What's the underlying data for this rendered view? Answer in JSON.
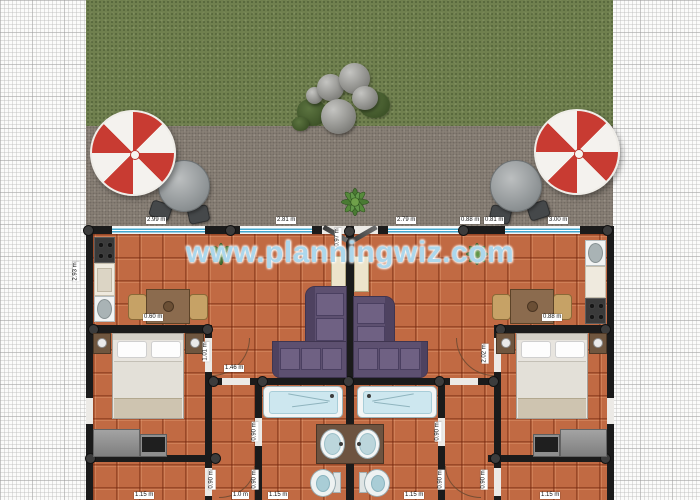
{
  "watermark": {
    "text": "www.planningwiz.com"
  },
  "dimension_labels": [
    {
      "text": "2.99 m"
    },
    {
      "text": "2.81 m"
    },
    {
      "text": "2.79 m"
    },
    {
      "text": "0.88 m"
    },
    {
      "text": "0.81 m"
    },
    {
      "text": "3.00 m"
    },
    {
      "text": "2.93 m"
    },
    {
      "text": "0.97 m"
    },
    {
      "text": "1.01 m"
    },
    {
      "text": "1.46 m"
    },
    {
      "text": "2.02 m"
    },
    {
      "text": "0.88 m"
    },
    {
      "text": "0.60 m"
    },
    {
      "text": "0.90 m"
    },
    {
      "text": "0.90 m"
    },
    {
      "text": "0.90 m"
    },
    {
      "text": "0.90 m"
    },
    {
      "text": "0.90 m"
    },
    {
      "text": "0.90 m"
    },
    {
      "text": "1.15 m"
    },
    {
      "text": "1.0 m"
    },
    {
      "text": "1.15 m"
    },
    {
      "text": "1.15 m"
    },
    {
      "text": "1.15 m"
    }
  ],
  "colors": {
    "grass": "#70804f",
    "patio": "#8b8278",
    "tile": "#c16a43",
    "wall": "#1b1b1b",
    "window_blue": "#43a7cd",
    "sofa_purple": "#5d5070",
    "umbrella_red": "#c83b32",
    "watermark_blue": "#9ed0e9"
  }
}
